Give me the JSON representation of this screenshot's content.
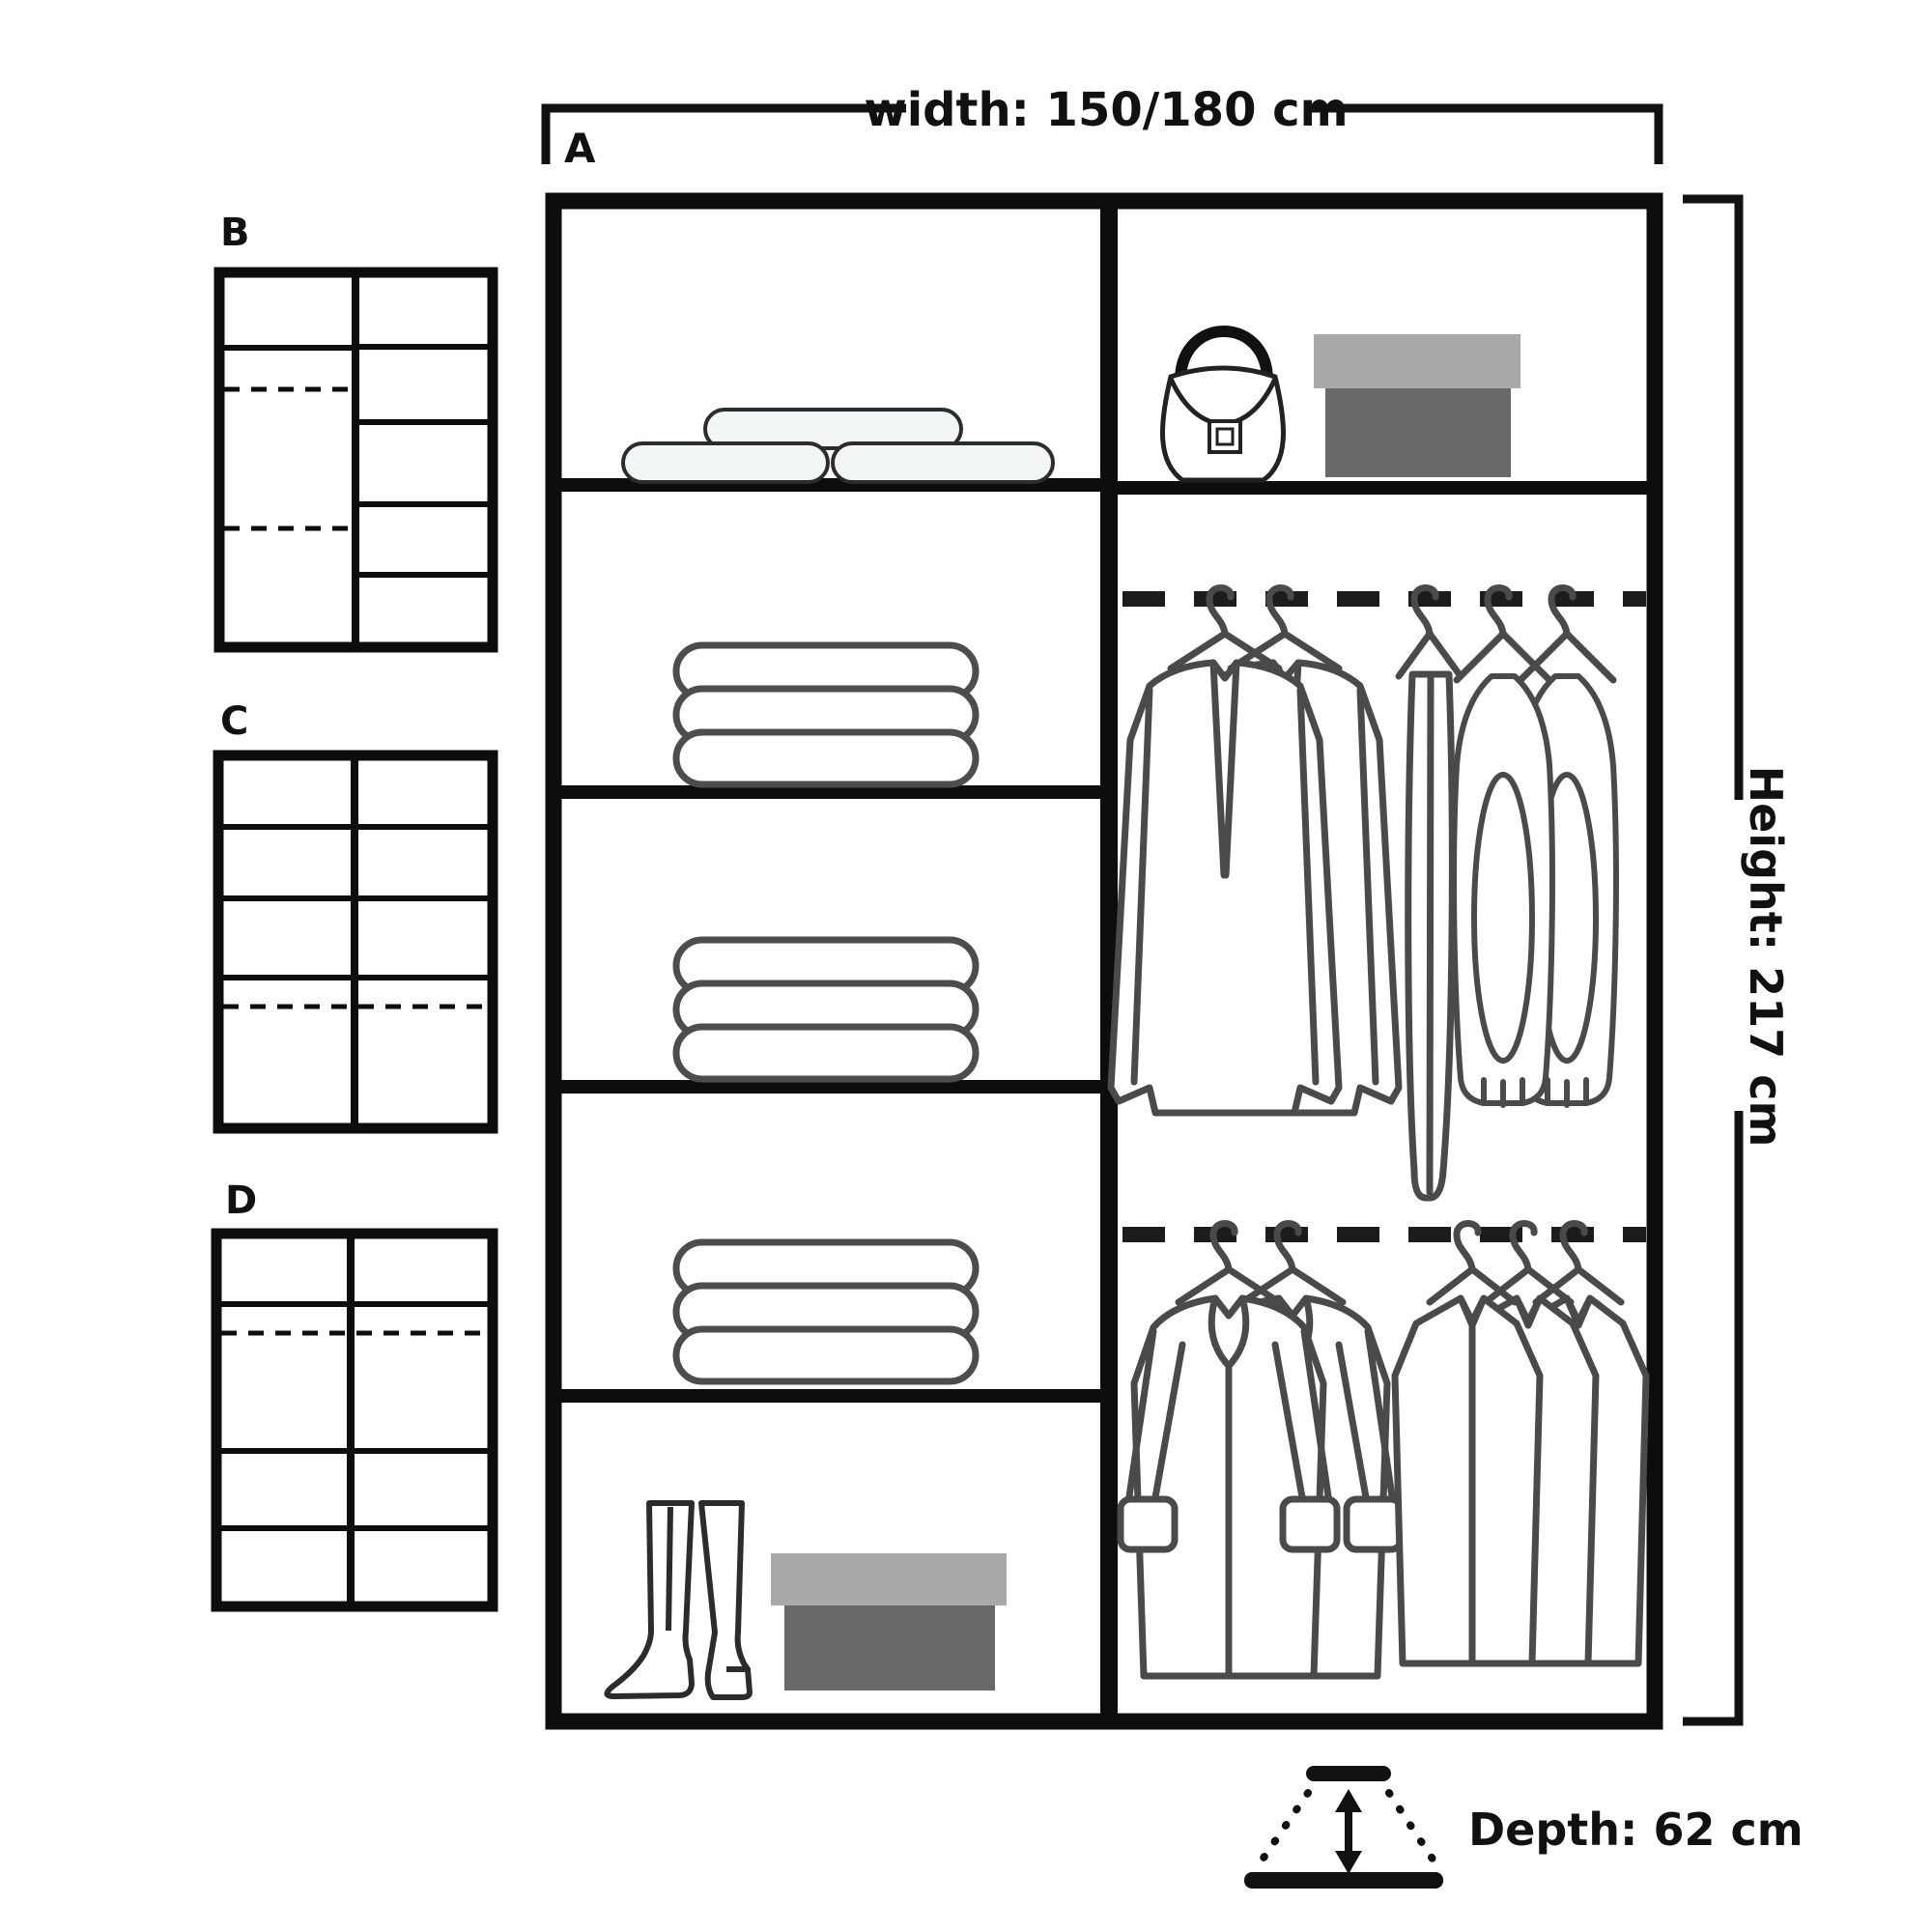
{
  "diagram": {
    "title_variant": "A",
    "variants": [
      {
        "label": "B"
      },
      {
        "label": "C"
      },
      {
        "label": "D"
      }
    ],
    "dimensions": {
      "width_label": "width: 150/180 cm",
      "height_label": "Height: 217 cm",
      "depth_label": "Depth: 62 cm"
    },
    "colors": {
      "line": "#111111",
      "garment_line": "#4a4a4a",
      "shoebox_lid": "#a9a9a9",
      "shoebox_base": "#696969",
      "pillow_fill": "#f3f6f6"
    },
    "icons": [
      "pillows-icon",
      "folded-towels-icon",
      "handbag-icon",
      "shoebox-icon",
      "boots-icon",
      "hanging-rail-icon",
      "suit-jackets-icon",
      "pants-hanger-icon",
      "vests-icon",
      "cuffed-coats-icon",
      "shirts-icon",
      "depth-arrows-icon"
    ]
  }
}
